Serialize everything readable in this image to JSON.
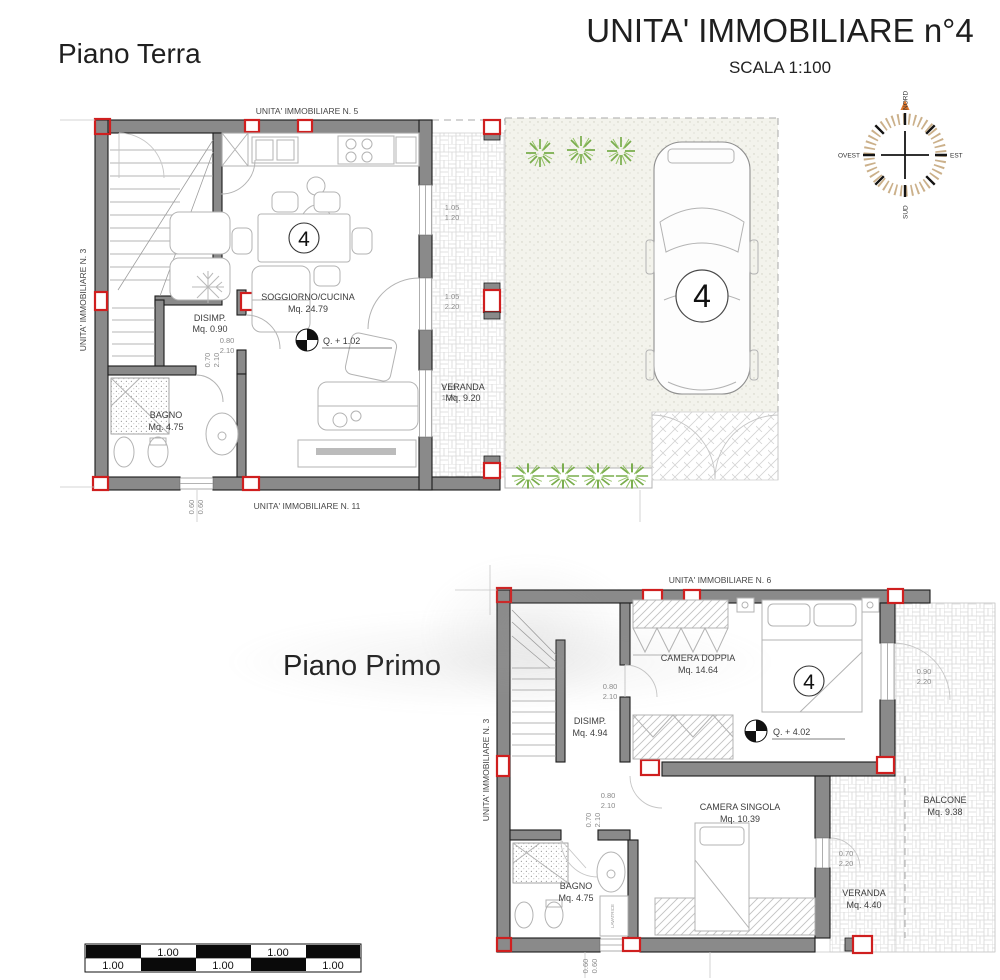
{
  "header": {
    "title": "UNITA' IMMOBILIARE n°4",
    "scale_note": "SCALA 1:100",
    "ground_floor_label": "Piano Terra",
    "first_floor_label": "Piano Primo"
  },
  "compass": {
    "north": "NORD",
    "south": "SUD",
    "east": "EST",
    "west": "OVEST"
  },
  "colors": {
    "wall_gray": "#8a8a8a",
    "pillar_red": "#cf1f1f",
    "plant_green": "#79ad4c",
    "compass_orange": "#e0762a"
  },
  "ground": {
    "neighbor_top": "UNITA' IMMOBILIARE N. 5",
    "neighbor_left": "UNITA' IMMOBILIARE N. 3",
    "neighbor_bottom": "UNITA' IMMOBILIARE N. 11",
    "unit_badge": "4",
    "car_badge": "4",
    "level_mark": "Q. + 1.02",
    "rooms": {
      "living": {
        "name": "SOGGIORNO/CUCINA",
        "area": "Mq. 24.79"
      },
      "disimp": {
        "name": "DISIMP.",
        "area": "Mq. 0.90"
      },
      "bagno": {
        "name": "BAGNO",
        "area": "Mq. 4.75"
      },
      "veranda": {
        "name": "VERANDA",
        "area": "Mq. 9.20"
      }
    },
    "dims": {
      "disimp_door_w": "0.80",
      "disimp_door_h": "2.10",
      "bagno_door_w": "0.70",
      "bagno_door_h": "2.10",
      "win1_w": "1.05",
      "win1_h": "1.20",
      "door_w": "1.05",
      "door_h": "2.20",
      "win2_w": "1.05",
      "win2_h": "1.20",
      "low_win_w": "0.60",
      "low_win_h": "0.60"
    }
  },
  "first": {
    "neighbor_top": "UNITA' IMMOBILIARE N. 6",
    "neighbor_left": "UNITA' IMMOBILIARE N. 3",
    "unit_badge": "4",
    "level_mark": "Q. + 4.02",
    "appliance": "LAVATRICE",
    "rooms": {
      "camera_doppia": {
        "name": "CAMERA DOPPIA",
        "area": "Mq. 14.64"
      },
      "disimp": {
        "name": "DISIMP.",
        "area": "Mq. 4.94"
      },
      "camera_singola": {
        "name": "CAMERA SINGOLA",
        "area": "Mq. 10.39"
      },
      "bagno": {
        "name": "BAGNO",
        "area": "Mq. 4.75"
      },
      "balcone": {
        "name": "BALCONE",
        "area": "Mq. 9.38"
      },
      "veranda": {
        "name": "VERANDA",
        "area": "Mq. 4.40"
      }
    },
    "dims": {
      "doppia_door_w": "0.80",
      "doppia_door_h": "2.10",
      "singola_door_w": "0.80",
      "singola_door_h": "2.10",
      "bagno_door_w": "0.70",
      "bagno_door_h": "2.10",
      "balcone_win_w": "0.90",
      "balcone_win_h": "2.20",
      "veranda_win_w": "0.70",
      "veranda_win_h": "2.20",
      "low_win_w": "0.60",
      "low_win_h": "0.60"
    }
  },
  "scalebar": {
    "labels": [
      "1.00",
      "1.00",
      "1.00",
      "1.00",
      "1.00"
    ]
  }
}
